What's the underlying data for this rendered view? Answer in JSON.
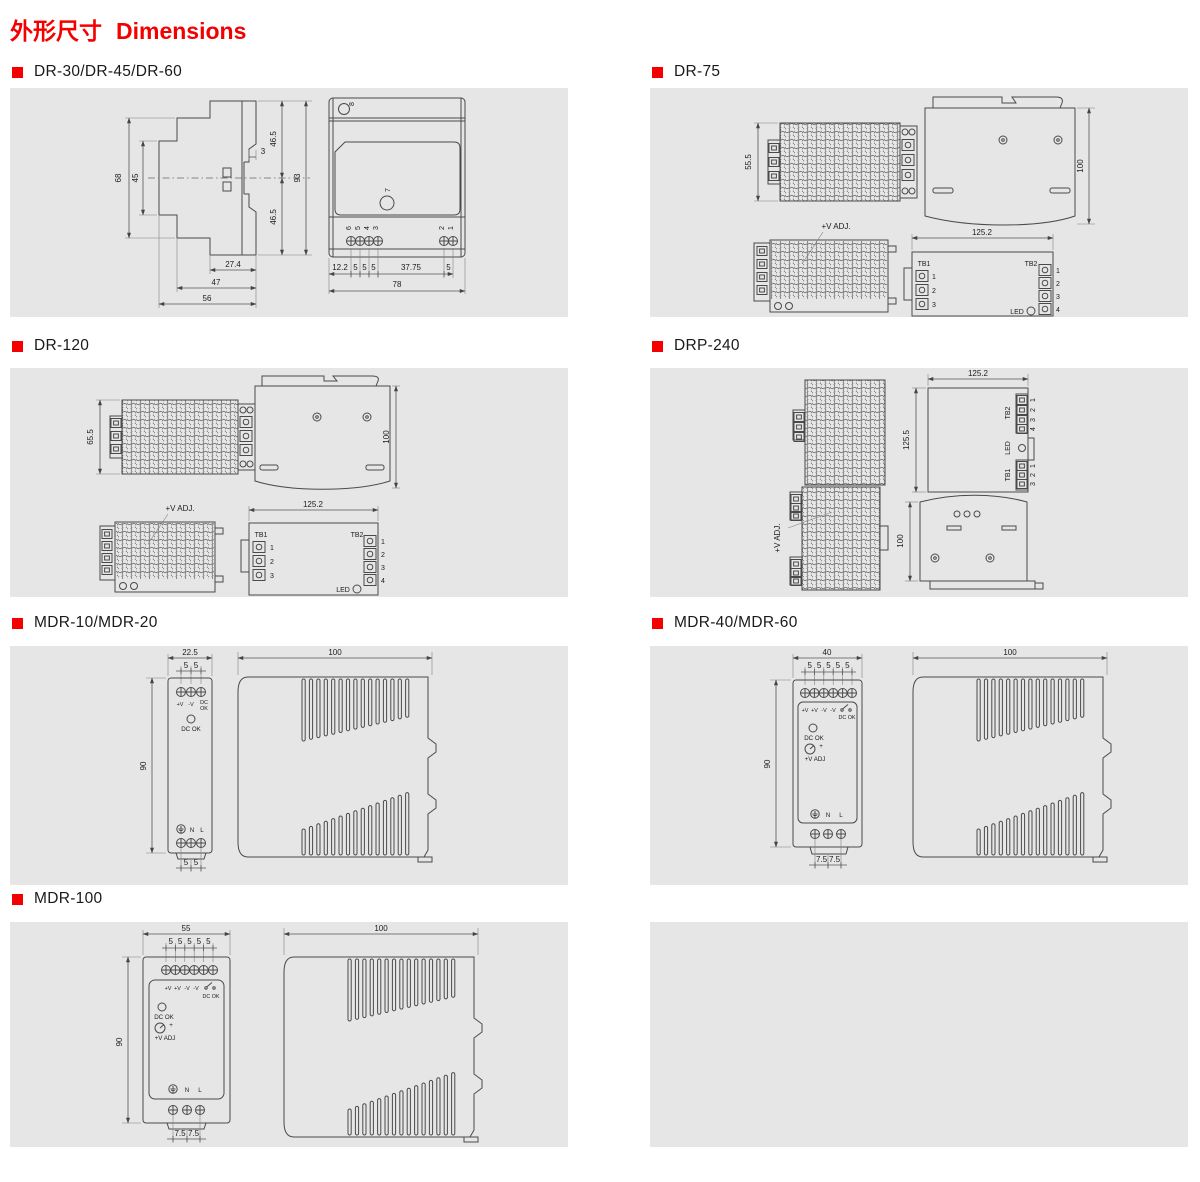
{
  "page": {
    "title_zh": "外形尺寸",
    "title_en": "Dimensions"
  },
  "colors": {
    "accent_red": "#f40000",
    "panel_bg": "#e6e6e6",
    "line": "#4a4a4a"
  },
  "sections": {
    "dr30": {
      "title": "DR-30/DR-45/DR-60",
      "side": {
        "h_outer": "68",
        "h_inner": "45",
        "h_top": "46.5",
        "step": "3",
        "h_bot": "46.5",
        "h_total": "93",
        "w_rail": "27.4",
        "w_mid": "47",
        "w_total": "56"
      },
      "front": {
        "hole_top": "8",
        "hole_front": "7",
        "pin6": "6",
        "pin5": "5",
        "pin4": "4",
        "pin3": "3",
        "pin2": "2",
        "pin1": "1",
        "d1": "12.2",
        "d2": "5",
        "d3": "5",
        "d4": "5",
        "d5": "37.75",
        "d6": "5",
        "w_total": "78"
      }
    },
    "dr75": {
      "title": "DR-75",
      "height": "55.5",
      "depth": "100",
      "width": "125.2",
      "vadj": "+V ADJ.",
      "tb1": "TB1",
      "tb2": "TB2",
      "led": "LED",
      "tb1_pins": [
        "1",
        "2",
        "3"
      ],
      "tb2_pins": [
        "1",
        "2",
        "3",
        "4"
      ]
    },
    "dr120": {
      "title": "DR-120",
      "height": "65.5",
      "depth": "100",
      "width": "125.2",
      "vadj": "+V ADJ.",
      "tb1": "TB1",
      "tb2": "TB2",
      "led": "LED",
      "tb1_pins": [
        "1",
        "2",
        "3"
      ],
      "tb2_pins": [
        "1",
        "2",
        "3",
        "4"
      ]
    },
    "drp240": {
      "title": "DRP-240",
      "width": "125.2",
      "height": "125.5",
      "depth": "100",
      "vadj": "+V ADJ.",
      "tb1": "TB1",
      "tb2": "TB2",
      "led": "LED",
      "tb1_pins": [
        "1",
        "2",
        "3"
      ],
      "tb2_pins": [
        "1",
        "2",
        "3",
        "4"
      ]
    },
    "mdr10": {
      "title": "MDR-10/MDR-20",
      "width": "22.5",
      "pitch": "5",
      "height": "90",
      "depth": "100",
      "t_vplus": "+V",
      "t_vminus": "-V",
      "t_dc": "DC",
      "t_ok": "OK",
      "led_label": "DC OK",
      "earth_n": "N",
      "earth_l": "L"
    },
    "mdr40": {
      "title": "MDR-40/MDR-60",
      "width": "40",
      "pitch": "5",
      "height": "90",
      "depth": "100",
      "bottom_pitch": "7.5",
      "t1": "+V",
      "t2": "+V",
      "t3": "-V",
      "t4": "-V",
      "dcok_contact": "DC OK",
      "led_label": "DC OK",
      "vadj": "+V ADJ",
      "plus": "+",
      "earth_n": "N",
      "earth_l": "L"
    },
    "mdr100": {
      "title": "MDR-100",
      "width": "55",
      "pitch": "5",
      "height": "90",
      "depth": "100",
      "bottom_pitch": "7.5",
      "t1": "+V",
      "t2": "+V",
      "t3": "-V",
      "t4": "-V",
      "dcok_contact": "DC OK",
      "led_label": "DC OK",
      "vadj": "+V ADJ",
      "plus": "+",
      "earth_n": "N",
      "earth_l": "L"
    }
  }
}
